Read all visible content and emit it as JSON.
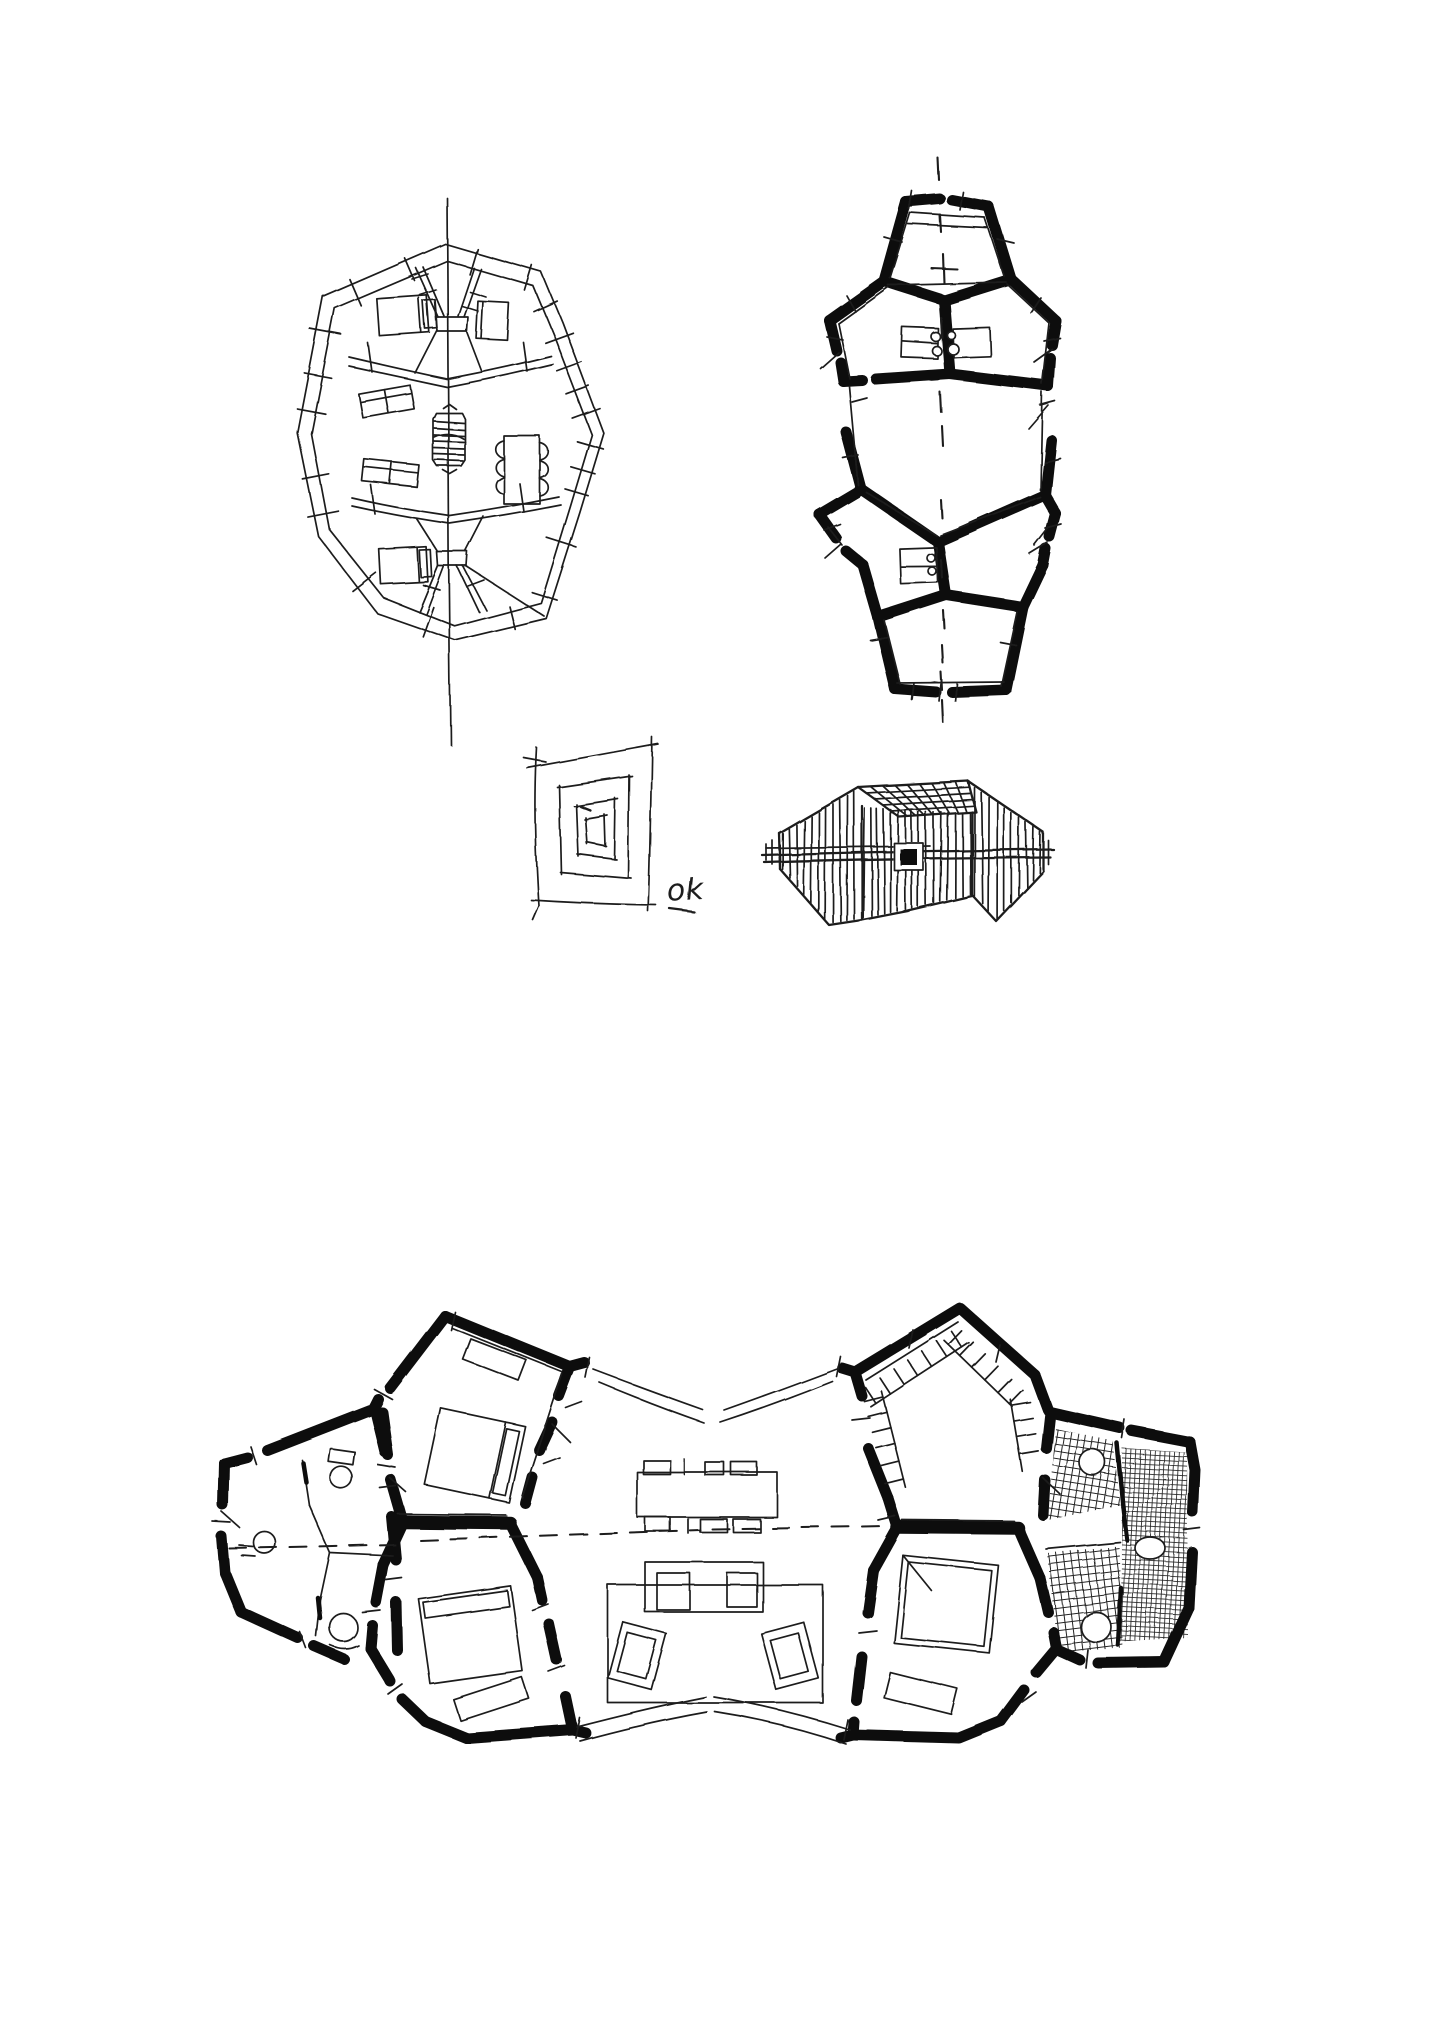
{
  "page": {
    "background": "#ffffff",
    "ink": "#1c1c1c",
    "description": "Sheet of freehand architectural pen sketches — studies of a house made of pentagonal rooms"
  },
  "annotation": {
    "text": "ok"
  },
  "figures": [
    {
      "id": "plan-light",
      "name": "Freehand plan study in thin pen — oval twin-lobe plan with beds, sofas, dining table and hatched central core",
      "position": "top-left"
    },
    {
      "id": "plan-bold",
      "name": "Plan study with heavy blackened walls — vertical chain of pentagonal rooms with kitchen blocks and dashed axis",
      "position": "top-right"
    },
    {
      "id": "nested-squares",
      "name": "Nested rectangles doodle",
      "position": "centre-left"
    },
    {
      "id": "massing",
      "name": "Hatched massing and roof sketch with solid black chimney square",
      "position": "centre-right"
    },
    {
      "id": "plan-large",
      "name": "Large plan — pentagonal bedrooms, west WC cluster and east hatched bathrooms around a central living hall",
      "position": "bottom"
    }
  ]
}
